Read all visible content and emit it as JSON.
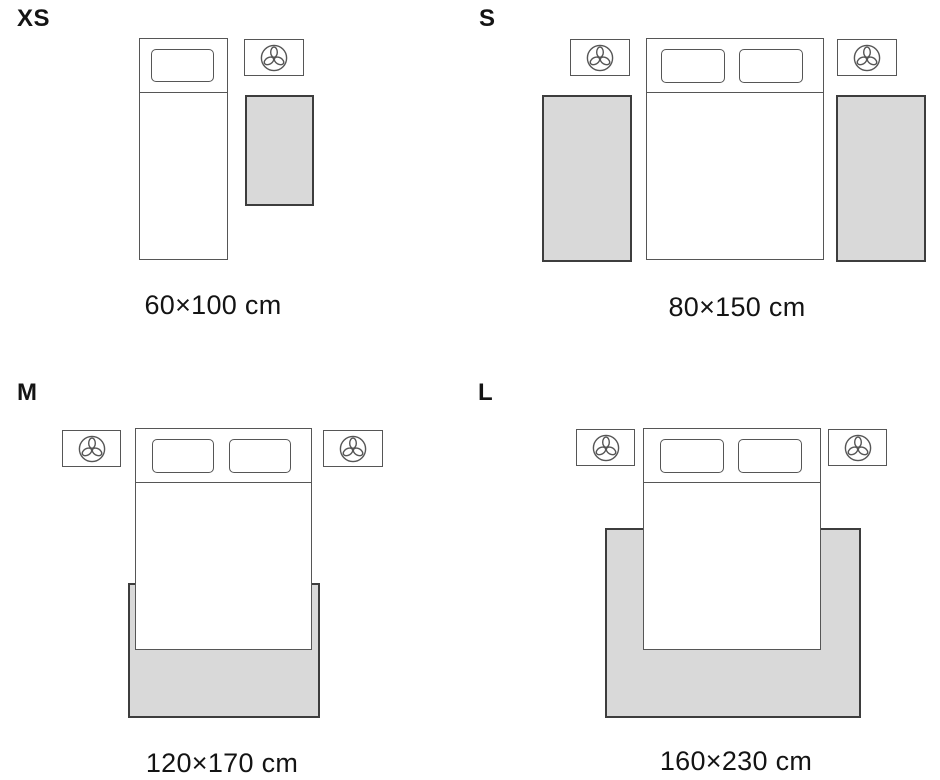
{
  "colors": {
    "background": "#ffffff",
    "rug_fill": "#d9d9d9",
    "rug_border": "#3d3d3d",
    "furniture_border": "#565656",
    "text": "#141414"
  },
  "sizes": [
    {
      "label": "XS",
      "caption": "60×100 cm",
      "bed": "single",
      "nightstands": 1,
      "rugs": 1,
      "rug_placement": "beside-bed"
    },
    {
      "label": "S",
      "caption": "80×150 cm",
      "bed": "double",
      "nightstands": 2,
      "rugs": 2,
      "rug_placement": "both-sides-of-bed"
    },
    {
      "label": "M",
      "caption": "120×170 cm",
      "bed": "double",
      "nightstands": 2,
      "rugs": 1,
      "rug_placement": "under-foot-of-bed"
    },
    {
      "label": "L",
      "caption": "160×230 cm",
      "bed": "double",
      "nightstands": 2,
      "rugs": 1,
      "rug_placement": "under-bed"
    }
  ],
  "icons": {
    "nightstand_icon": "plant-top-view"
  }
}
